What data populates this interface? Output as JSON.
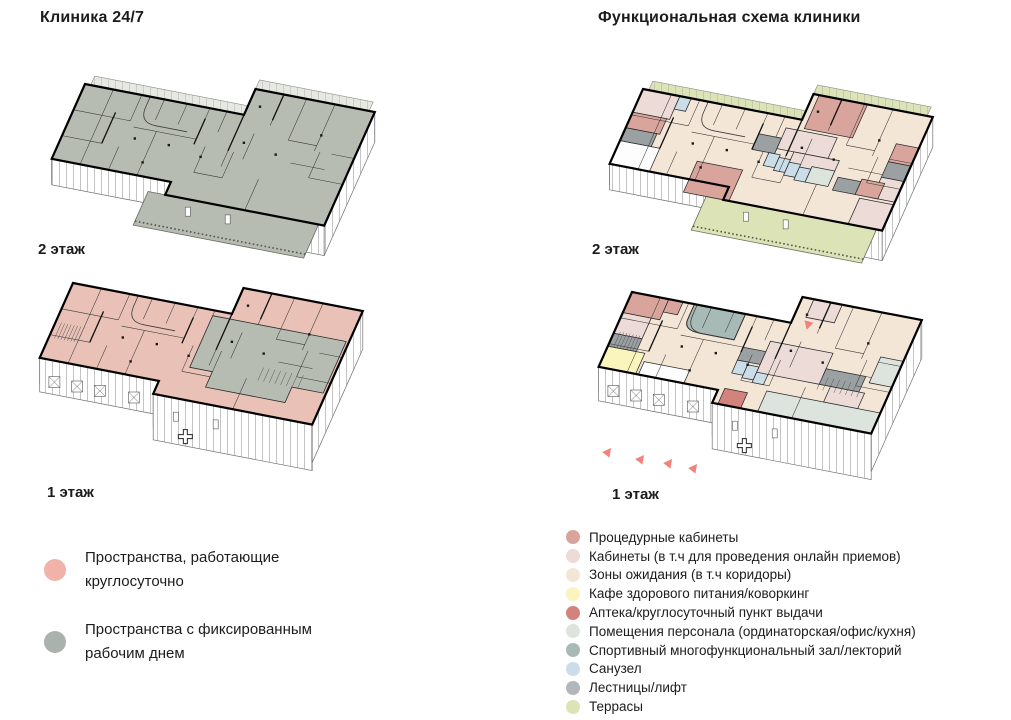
{
  "titles": {
    "left": "Клиника 24/7",
    "right": "Функциональная схема клиники"
  },
  "palette": {
    "always": "#f0b2a9",
    "fixed": "#a9b2ac",
    "always_fill": "#e9c1b6",
    "fixed_fill": "#b6bcb2",
    "proc": "#d9a49c",
    "kab": "#ecdbd7",
    "wait": "#f4e6d6",
    "cafe": "#faf5bd",
    "apteka": "#d2837c",
    "staff": "#dde4de",
    "sport": "#a8bab5",
    "sport_legend": "#b8c2be",
    "san": "#cbdde9",
    "stair": "#9ba0a2",
    "stair_dot": "#b2b8ba",
    "terrace": "#dce3b6",
    "white": "#fdfdfd",
    "arrow": "#f2837b"
  },
  "legend_24_7": [
    {
      "color": "always",
      "label": "Пространства, работающие круглосуточно"
    },
    {
      "color": "fixed",
      "label": "Пространства с фиксированным рабочим днем"
    }
  ],
  "legend_functional": [
    {
      "color": "proc",
      "label": "Процедурные кабинеты"
    },
    {
      "color": "kab",
      "label": "Кабинеты (в т.ч для проведения онлайн приемов)"
    },
    {
      "color": "wait",
      "label": "Зоны ожидания (в т.ч коридоры)"
    },
    {
      "color": "cafe",
      "label": "Кафе здорового питания/коворкинг"
    },
    {
      "color": "apteka",
      "label": "Аптека/круглосуточный пункт выдачи"
    },
    {
      "color": "staff",
      "label": "Помещения персонала (ординаторская/офис/кухня)"
    },
    {
      "color": "sport",
      "label": "Спортивный многофункциональный зал/лекторий"
    },
    {
      "color": "san",
      "label": "Санузел"
    },
    {
      "color": "stair_dot",
      "label": "Лестницы/лифт"
    },
    {
      "color": "terrace",
      "label": "Террасы"
    }
  ],
  "plans": [
    {
      "id": "left-2",
      "floor": "2 этаж",
      "origin": [
        85,
        84
      ],
      "level": 2,
      "base": "fixed_fill",
      "back_strip": "hatch",
      "front_terrace": "fixed_fill",
      "rooms": []
    },
    {
      "id": "left-1",
      "floor": "1 этаж",
      "origin": [
        73,
        283
      ],
      "level": 1,
      "base": "always_fill",
      "rooms": [
        {
          "cat": "fixed_fill",
          "poly": [
            [
              50,
              2
            ],
            [
              97,
              2
            ],
            [
              97,
              22
            ],
            [
              86,
              22
            ],
            [
              86,
              28
            ],
            [
              58,
              28
            ],
            [
              58,
              22
            ],
            [
              50,
              22
            ]
          ]
        }
      ],
      "cross": true
    },
    {
      "id": "right-2",
      "floor": "2 этаж",
      "origin": [
        643,
        89
      ],
      "level": 2,
      "base": "wait",
      "back_strip": "terrace",
      "front_terrace": "terrace",
      "rooms": [
        {
          "cat": "kab",
          "rect": [
            0,
            0,
            13,
            9
          ]
        },
        {
          "cat": "san",
          "rect": [
            13,
            0,
            17,
            5
          ]
        },
        {
          "cat": "proc",
          "rect": [
            0,
            9,
            12,
            15
          ]
        },
        {
          "cat": "stair",
          "rect": [
            0,
            15,
            11,
            20
          ]
        },
        {
          "cat": "white",
          "rect": [
            0,
            20,
            14,
            29
          ]
        },
        {
          "cat": "proc",
          "rect": [
            58,
            -10,
            75,
            3
          ]
        },
        {
          "cat": "proc",
          "rect": [
            90,
            2,
            98,
            9
          ]
        },
        {
          "cat": "stair",
          "rect": [
            90,
            9,
            98,
            15
          ]
        },
        {
          "cat": "kab",
          "rect": [
            90,
            15,
            98,
            23
          ]
        },
        {
          "cat": "stair",
          "rect": [
            44,
            8,
            52,
            14
          ]
        },
        {
          "cat": "kab",
          "rect": [
            52,
            4,
            70,
            12
          ]
        },
        {
          "cat": "kab",
          "rect": [
            58,
            12,
            74,
            20
          ]
        },
        {
          "cat": "san",
          "rect": [
            50,
            14,
            54,
            19
          ]
        },
        {
          "cat": "san",
          "rect": [
            54,
            15,
            58,
            20
          ]
        },
        {
          "cat": "san",
          "rect": [
            58,
            16,
            62,
            21
          ]
        },
        {
          "cat": "san",
          "rect": [
            62,
            17,
            66,
            22
          ]
        },
        {
          "cat": "staff",
          "rect": [
            66,
            16,
            74,
            22
          ]
        },
        {
          "cat": "proc",
          "rect": [
            28,
            22,
            44,
            34
          ]
        },
        {
          "cat": "stair",
          "rect": [
            76,
            18,
            84,
            23
          ]
        },
        {
          "cat": "proc",
          "rect": [
            84,
            17,
            92,
            23
          ]
        },
        {
          "cat": "kab",
          "rect": [
            86,
            24,
            98,
            34
          ]
        }
      ]
    },
    {
      "id": "right-1",
      "floor": "1 этаж",
      "origin": [
        632,
        292
      ],
      "level": 1,
      "base": "wait",
      "rooms": [
        {
          "cat": "proc",
          "rect": [
            0,
            0,
            13,
            8
          ]
        },
        {
          "cat": "proc",
          "rect": [
            13,
            0,
            18,
            5
          ]
        },
        {
          "cat": "kab",
          "rect": [
            0,
            8,
            10,
            16
          ]
        },
        {
          "cat": "stair",
          "rect": [
            0,
            16,
            10,
            21
          ]
        },
        {
          "cat": "cafe",
          "rect": [
            0,
            21,
            13,
            29
          ]
        },
        {
          "cat": "sport",
          "rect": [
            22,
            0,
            40,
            10
          ],
          "rounded": true
        },
        {
          "cat": "white",
          "rect": [
            14,
            24,
            30,
            29
          ]
        },
        {
          "cat": "kab",
          "rect": [
            60,
            -10,
            70,
            -3
          ]
        },
        {
          "cat": "stair",
          "rect": [
            44,
            12,
            52,
            17
          ]
        },
        {
          "cat": "san",
          "rect": [
            44,
            17,
            48,
            22
          ]
        },
        {
          "cat": "san",
          "rect": [
            48,
            18,
            52,
            23
          ]
        },
        {
          "cat": "san",
          "rect": [
            52,
            19,
            56,
            24
          ]
        },
        {
          "cat": "kab",
          "rect": [
            52,
            8,
            74,
            20
          ]
        },
        {
          "cat": "apteka",
          "rect": [
            44,
            28,
            52,
            34
          ]
        },
        {
          "cat": "staff",
          "rect": [
            58,
            26,
            98,
            34
          ]
        },
        {
          "cat": "staff",
          "rect": [
            90,
            6,
            98,
            16
          ]
        },
        {
          "cat": "stair",
          "rect": [
            74,
            14,
            88,
            20
          ]
        },
        {
          "cat": "kab",
          "rect": [
            78,
            20,
            90,
            26
          ]
        }
      ],
      "cross": true,
      "arrows": [
        {
          "x": 608,
          "y": 452,
          "r": 38
        },
        {
          "x": 641,
          "y": 459,
          "r": 38
        },
        {
          "x": 669,
          "y": 463,
          "r": 38
        },
        {
          "x": 694,
          "y": 468,
          "r": 38
        },
        {
          "x": 808,
          "y": 325,
          "r": 195
        }
      ]
    }
  ]
}
